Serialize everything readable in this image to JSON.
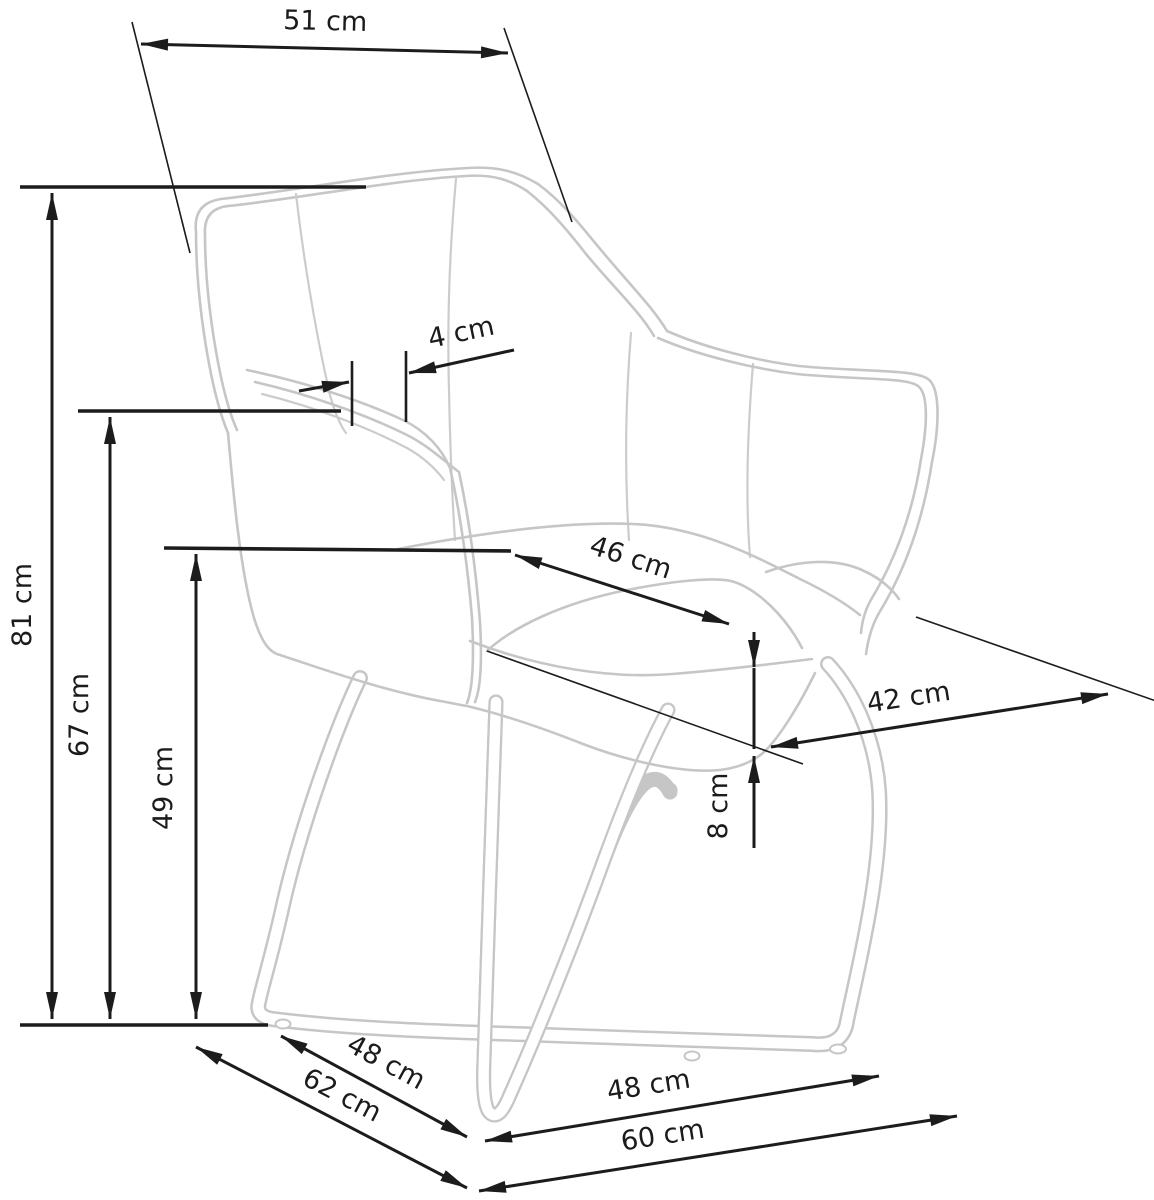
{
  "diagram": {
    "kind": "furniture dimension drawing",
    "subject": "upholstered armchair with crossed sled base",
    "unit": "cm",
    "colors": {
      "background": "#ffffff",
      "dimension_lines": "#1c1c1c",
      "chair_outline": "#c6c6c6"
    },
    "dimensions": [
      {
        "id": "back-top-width",
        "label": "51 cm",
        "value": 51
      },
      {
        "id": "armrest-edge-thickness",
        "label": "4 cm",
        "value": 4
      },
      {
        "id": "total-height",
        "label": "81 cm",
        "value": 81
      },
      {
        "id": "armrest-height",
        "label": "67 cm",
        "value": 67
      },
      {
        "id": "seat-height",
        "label": "49 cm",
        "value": 49
      },
      {
        "id": "seat-width",
        "label": "46 cm",
        "value": 46
      },
      {
        "id": "seat-depth",
        "label": "42 cm",
        "value": 42
      },
      {
        "id": "seat-edge-thickness",
        "label": "8 cm",
        "value": 8
      },
      {
        "id": "base-side-length",
        "label": "48 cm",
        "value": 48
      },
      {
        "id": "base-depth",
        "label": "62 cm",
        "value": 62
      },
      {
        "id": "base-front-length",
        "label": "48 cm",
        "value": 48
      },
      {
        "id": "base-width",
        "label": "60 cm",
        "value": 60
      }
    ]
  }
}
